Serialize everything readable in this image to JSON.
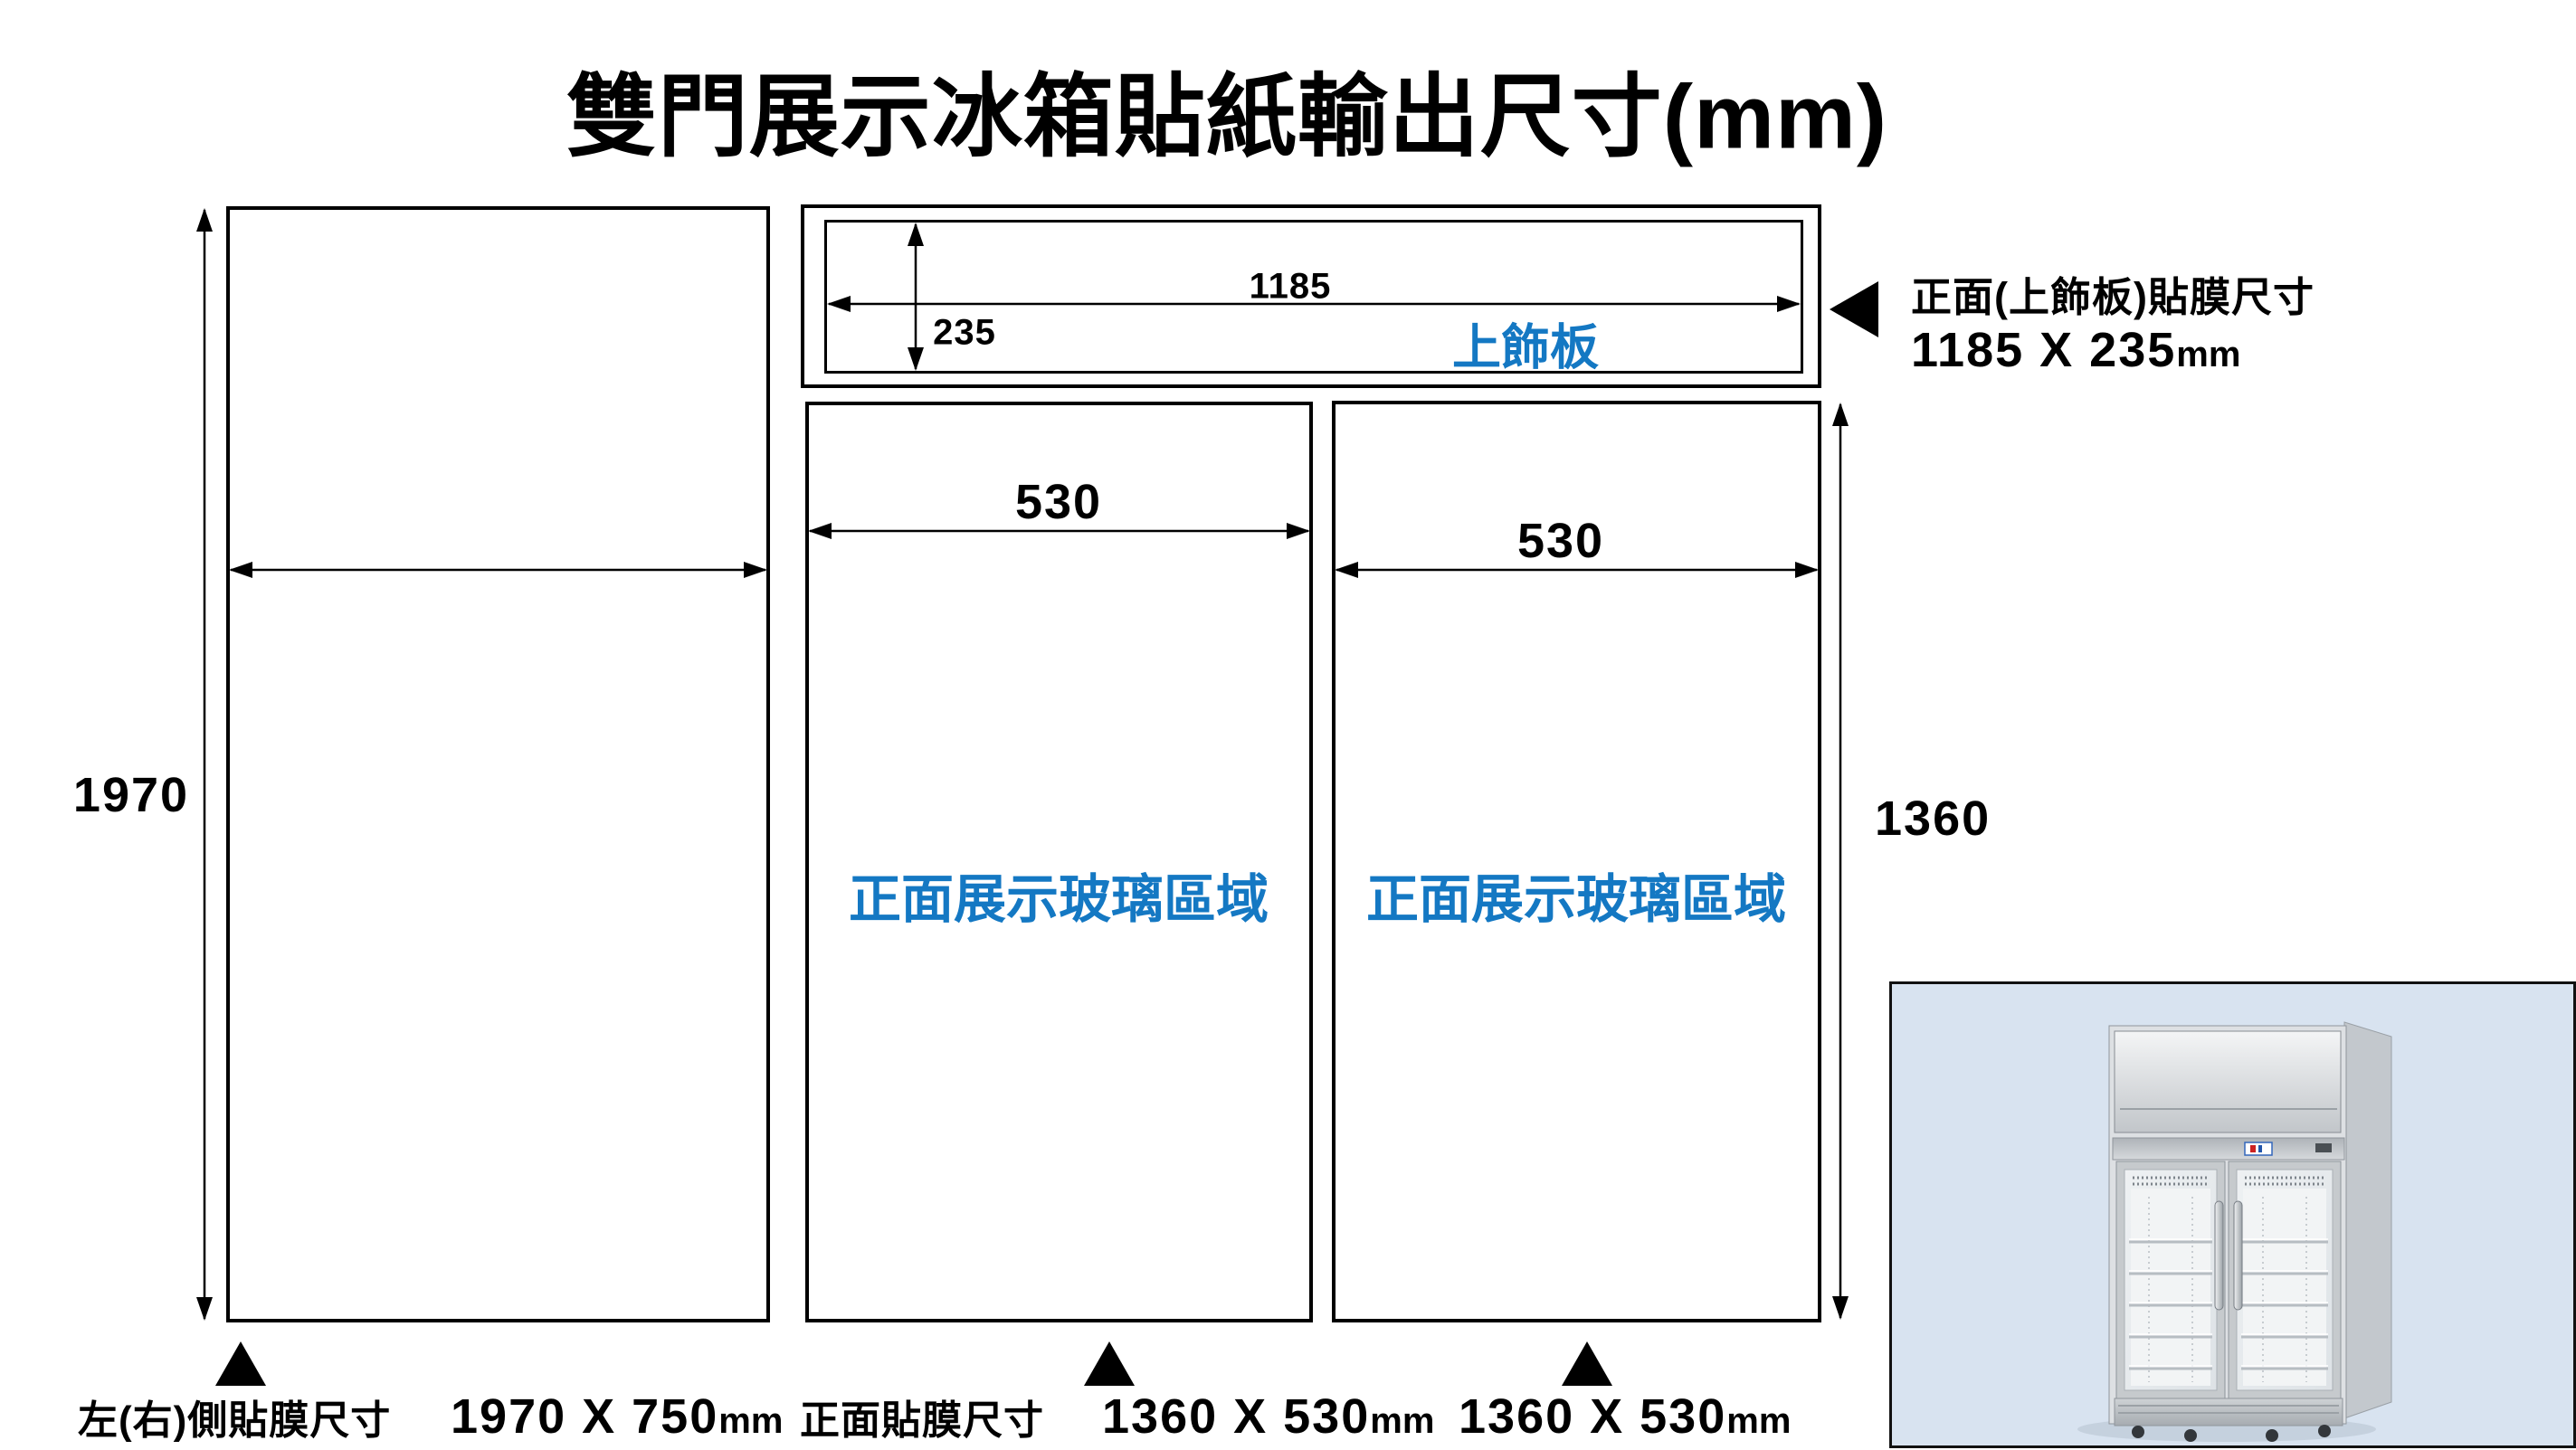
{
  "title": "雙門展示冰箱貼紙輸出尺寸(mm)",
  "colors": {
    "accent_blue": "#1478c3",
    "line_black": "#000000",
    "photo_background": "#d8e3f0"
  },
  "top_panel": {
    "label": "上飾板",
    "width_dim": "1185",
    "height_dim": "235"
  },
  "side_panel": {
    "height_dim": "1970"
  },
  "front_panels": {
    "left_width_dim": "530",
    "right_width_dim": "530",
    "height_dim": "1360",
    "left_label": "正面展示玻璃區域",
    "right_label": "正面展示玻璃區域"
  },
  "callout": {
    "line1": "正面(上飾板)貼膜尺寸",
    "size": "1185 X 235",
    "unit": "mm"
  },
  "captions": {
    "side_label": "左(右)側貼膜尺寸",
    "side_size": "1970 X 750",
    "side_unit": "mm",
    "front_label": "正面貼膜尺寸",
    "front_size1": "1360 X 530",
    "front_unit1": "mm",
    "front_size2": "1360 X 530",
    "front_unit2": "mm"
  }
}
